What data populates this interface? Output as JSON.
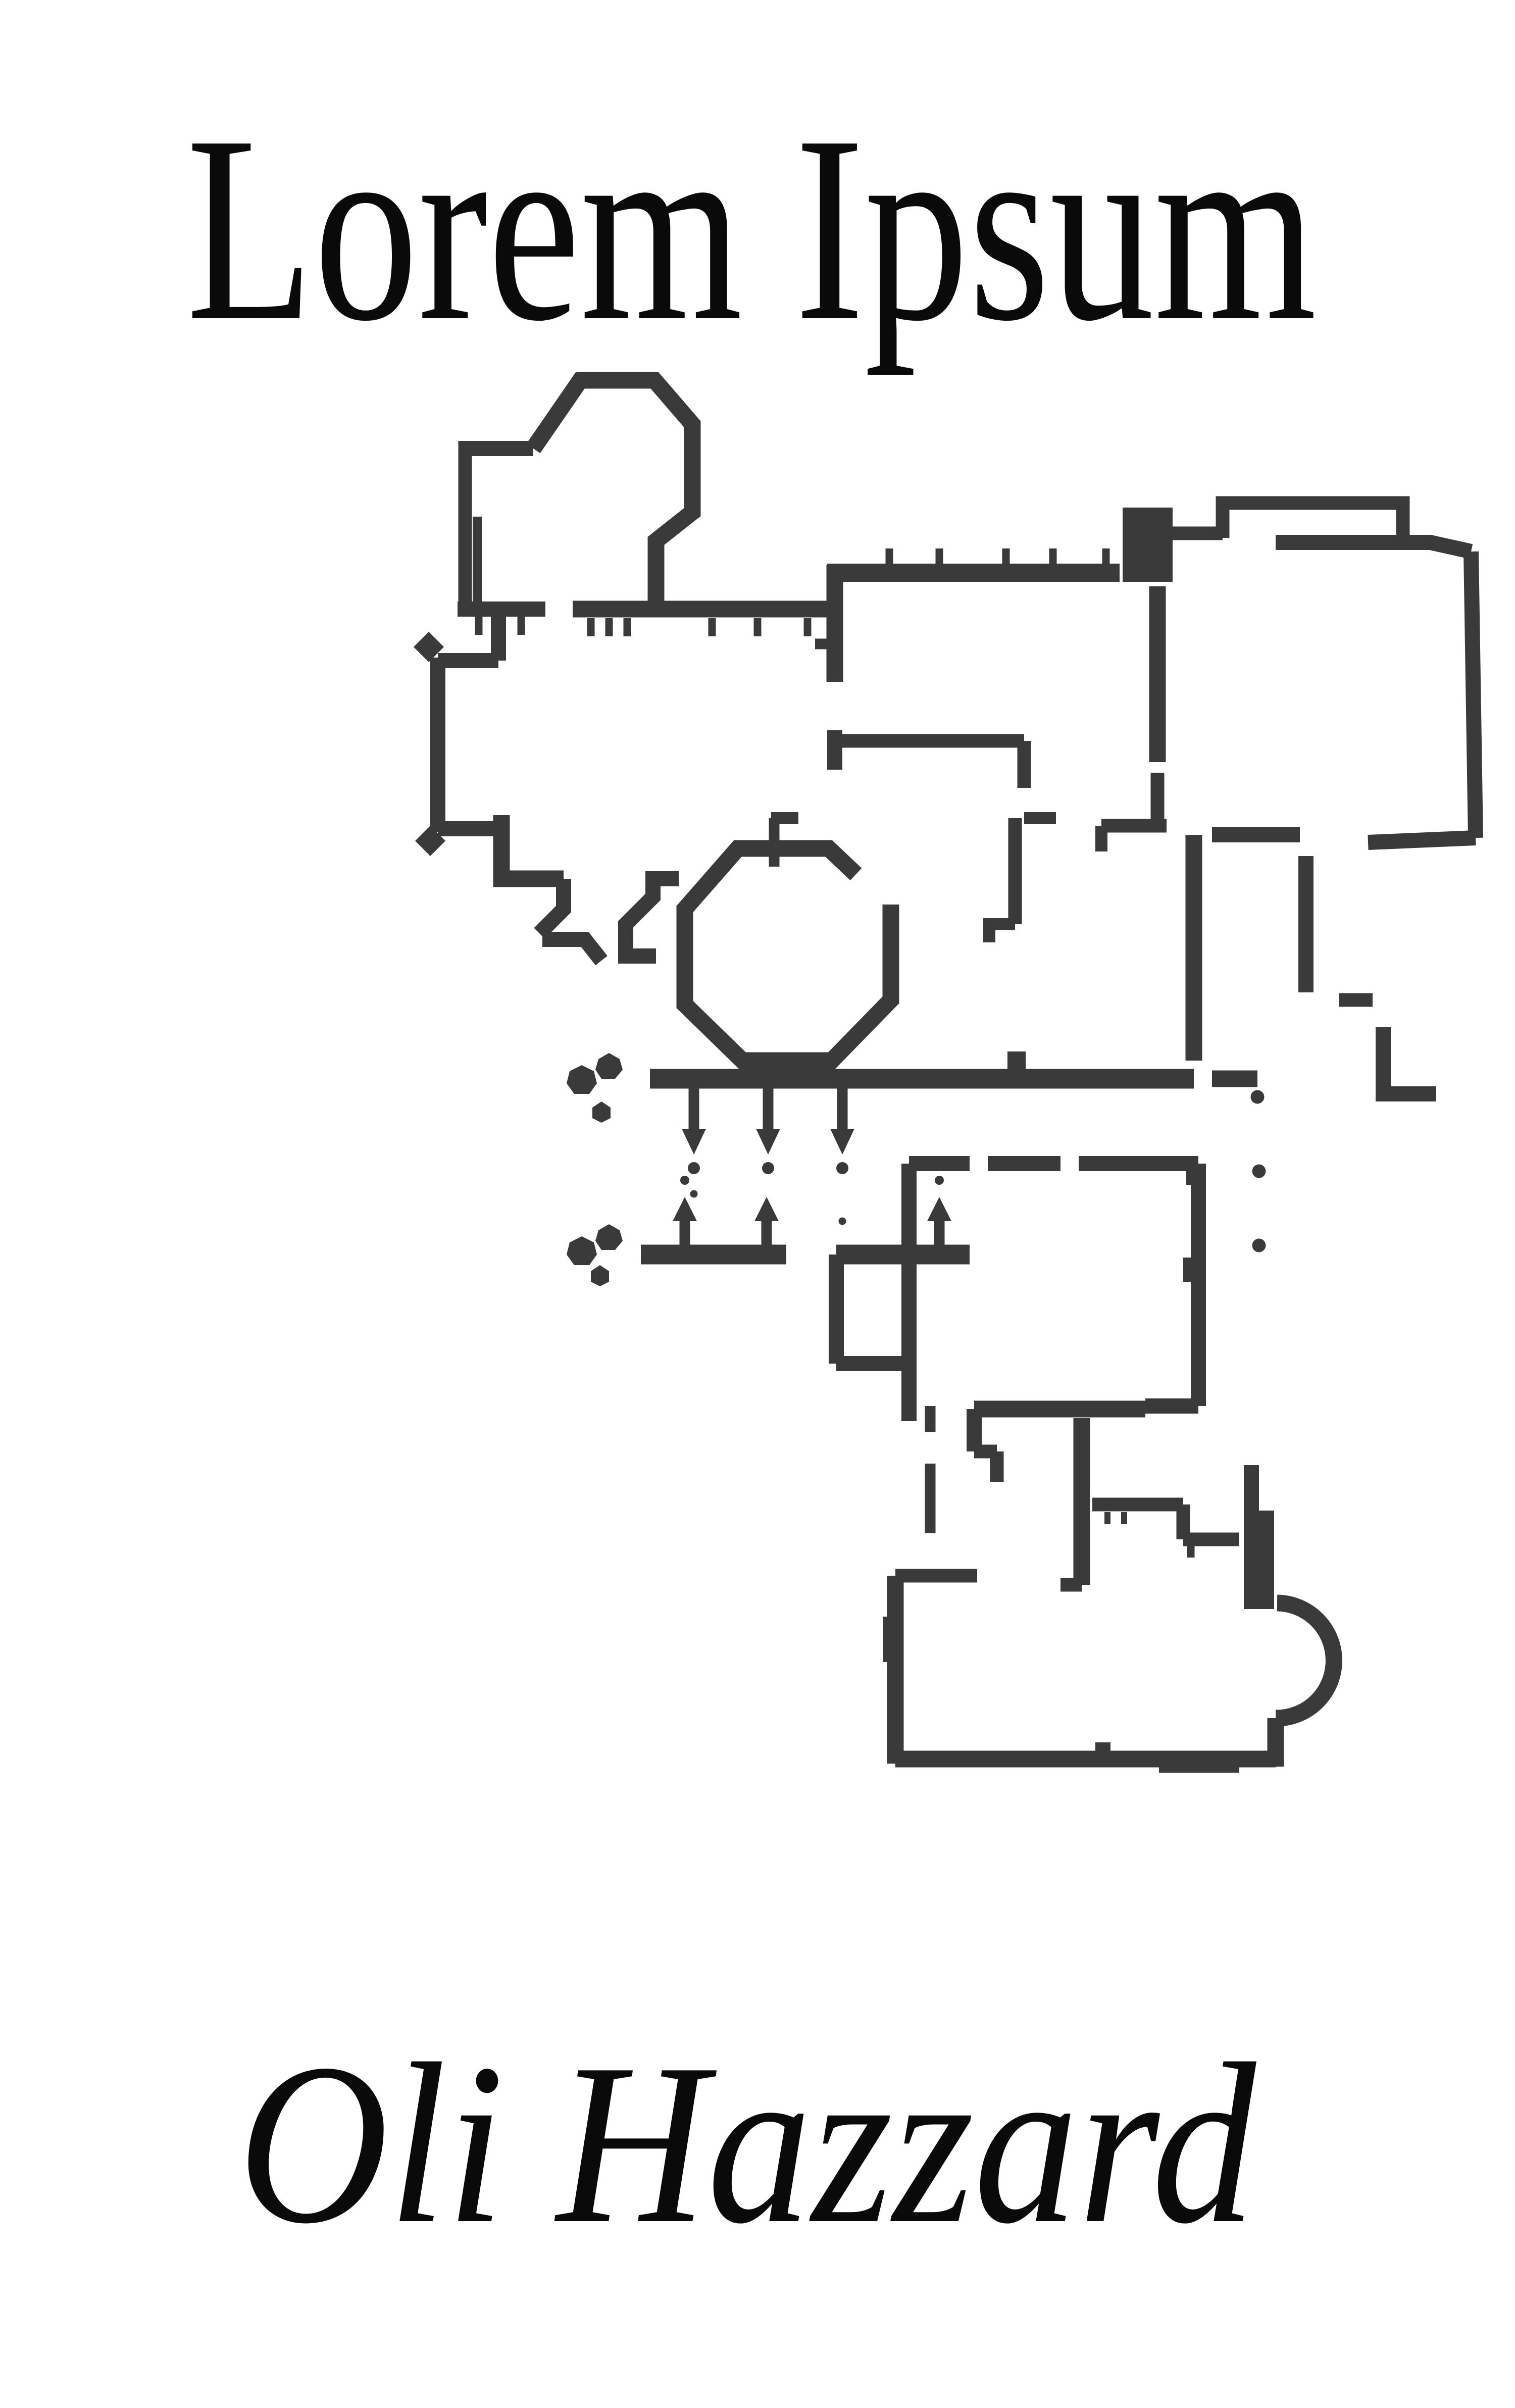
{
  "cover": {
    "title": "Lorem Ipsum",
    "author": "Oli Hazzard",
    "ink_color": "#3a3a3a",
    "text_color": "#0a0a0a",
    "background_color": "#ffffff",
    "artwork": "architectural floor plan drawing"
  }
}
